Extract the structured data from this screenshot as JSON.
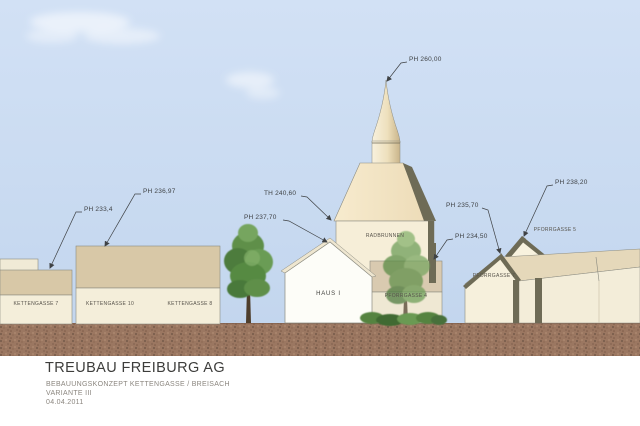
{
  "drawing": {
    "type": "architectural-elevation-concept",
    "annotations": {
      "ph_kettengasse7": "PH 233,4",
      "ph_kettengasse": "PH 236,97",
      "th_radbrunnen": "TH 240,60",
      "ph_haus1": "PH 237,70",
      "ph_spire": "PH 260,00",
      "ph_pforrgasse7": "PH 235,70",
      "ph_pforrgasse4": "PH 234,50",
      "ph_pforrgasse5": "PH 238,20"
    },
    "buildings": {
      "kettengasse7": "KETTENGASSE 7",
      "kettengasse10": "KETTENGASSE 10",
      "kettengasse8": "KETTENGASSE 8",
      "haus1": "HAUS I",
      "radbrunnen": "RADBRUNNEN",
      "pforrgasse4": "PFORRGASSE 4",
      "pforrgasse7": "PFORRGASSE 7",
      "pforrgasse5": "PFORRGASSE 5"
    },
    "title_block": {
      "company": "TREUBAU FREIBURG AG",
      "project": "BEBAUUNGSKONZEPT KETTENGASSE / BREISACH",
      "variant": "VARIANTE III",
      "date": "04.04.2011"
    },
    "colors": {
      "sky": "#c9dbf1",
      "ground": "#9b7761",
      "facade_light": "#f4eeda",
      "facade_tan": "#d8c8a7",
      "tower_roof": "#f3e6c8",
      "roof_dark": "#6e6b56",
      "tree_green": "#5d8c48",
      "annotation_line": "#3f4245"
    }
  }
}
